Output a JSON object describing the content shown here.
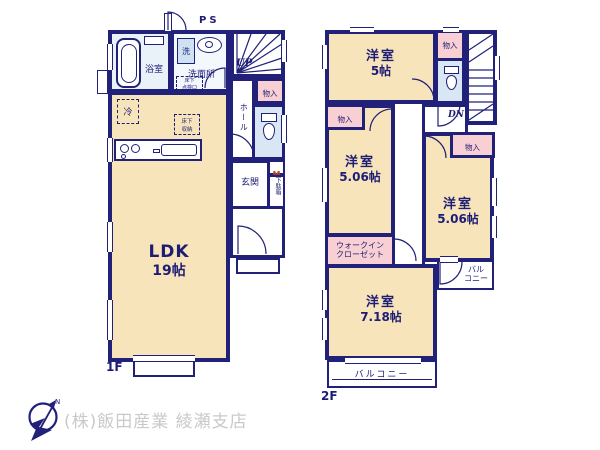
{
  "footer": {
    "company": "(株)飯田産業 綾瀬支店",
    "compass_n": "N"
  },
  "floor1": {
    "label": "1F",
    "ps": "PS",
    "up": "UP",
    "rooms": {
      "ldk_name": "LDK",
      "ldk_size": "19帖",
      "bath": "浴室",
      "washer": "洗",
      "washroom": "洗面所",
      "entrance": "玄関",
      "hall": "ホール",
      "closet": "物入",
      "meter": "M",
      "shoe_box": "下駄箱",
      "fridge": "冷"
    },
    "notes": {
      "underfloor_storage": [
        "床下",
        "収納"
      ],
      "underfloor_hatch": [
        "床下",
        "点検口"
      ]
    }
  },
  "floor2": {
    "label": "2F",
    "dn": "DN",
    "rooms": {
      "bedroom1_name": "洋室",
      "bedroom1_size": "5帖",
      "bedroom2_name": "洋室",
      "bedroom2_size": "5.06帖",
      "bedroom3_name": "洋室",
      "bedroom3_size": "5.06帖",
      "bedroom4_name": "洋室",
      "bedroom4_size": "7.18帖",
      "closet_top": "物入",
      "closet_left": "物入",
      "closet_right": "物入",
      "wic": [
        "ウォークイン",
        "クローゼット"
      ],
      "balcony": "バルコニー",
      "balcony_side": [
        "バル",
        "コニー"
      ]
    }
  },
  "colors": {
    "wall": "#21217a",
    "room": "#f7e4ba",
    "closet": "#f8cfd3",
    "wet": "#d9e7f4",
    "bath": "#e9f1f9",
    "text": "#1d1d75",
    "meter": "#c2491f",
    "company": "#c9c9ca"
  }
}
